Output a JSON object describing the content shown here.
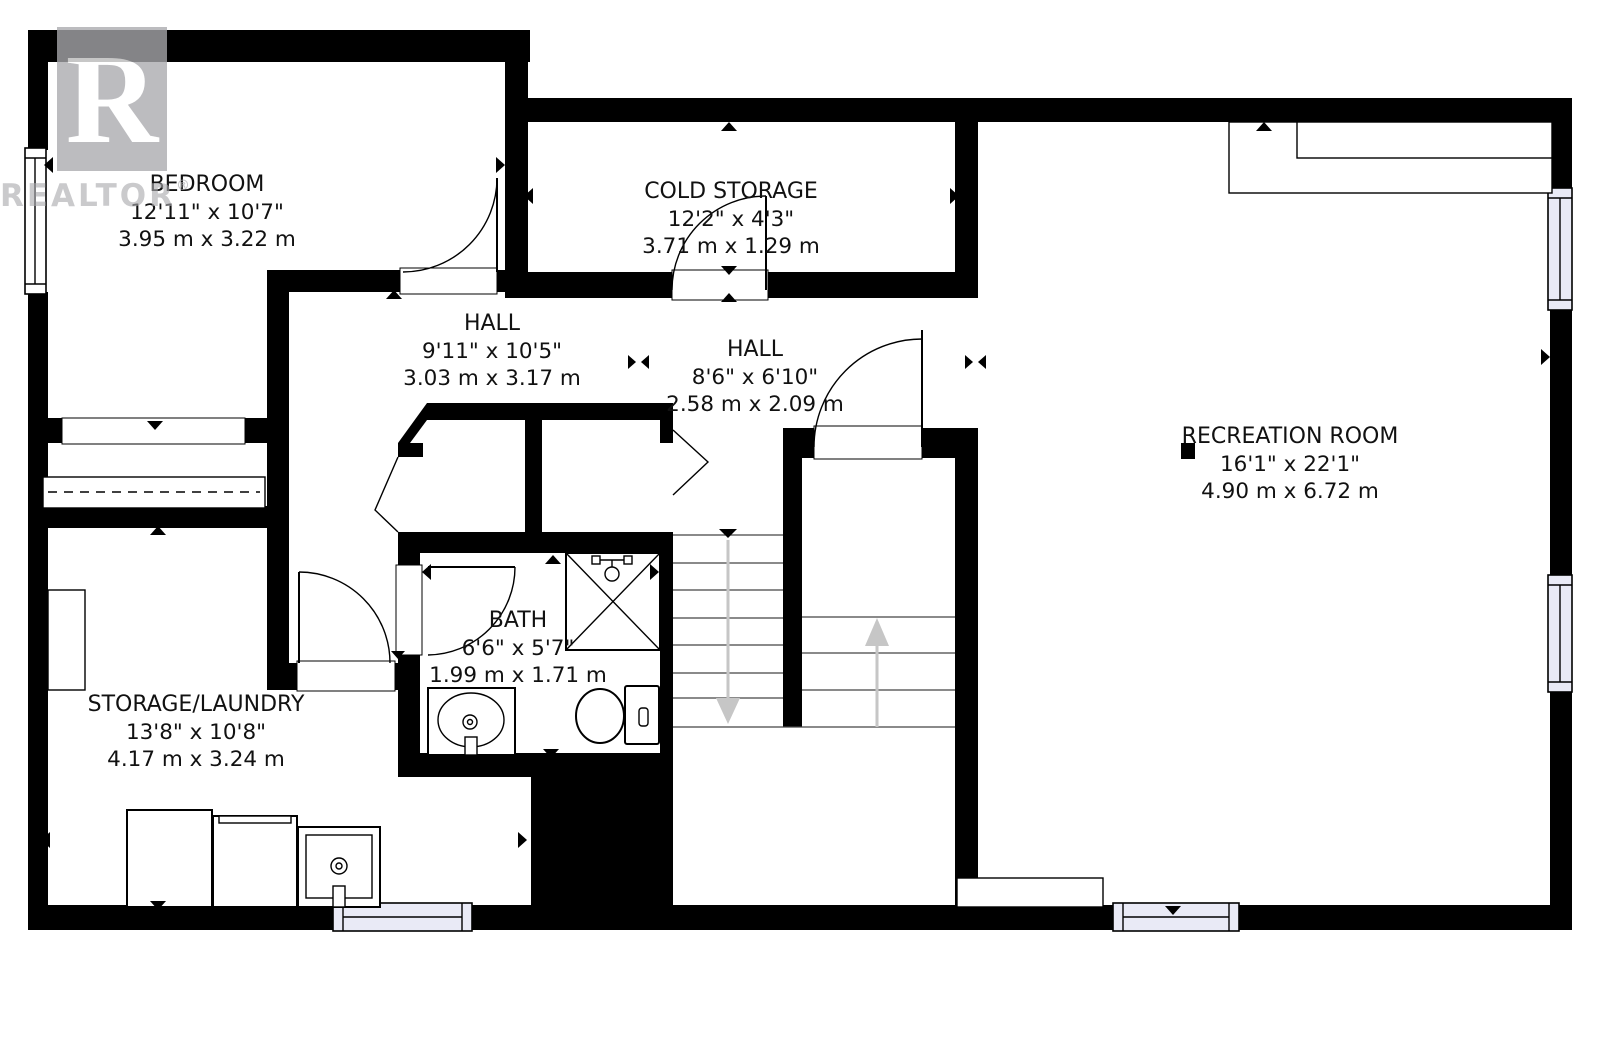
{
  "title": "Basement floor plan",
  "watermark": {
    "logo_letter": "R",
    "text": "REALTOR",
    "registered": "®"
  },
  "rooms": {
    "bedroom": {
      "name": "BEDROOM",
      "imperial": "12'11\" x 10'7\"",
      "metric": "3.95 m x 3.22 m"
    },
    "cold_storage": {
      "name": "COLD STORAGE",
      "imperial": "12'2\" x 4'3\"",
      "metric": "3.71 m x 1.29 m"
    },
    "hall1": {
      "name": "HALL",
      "imperial": "9'11\" x 10'5\"",
      "metric": "3.03 m x 3.17 m"
    },
    "hall2": {
      "name": "HALL",
      "imperial": "8'6\" x 6'10\"",
      "metric": "2.58 m x 2.09 m"
    },
    "recreation": {
      "name": "RECREATION ROOM",
      "imperial": "16'1\" x 22'1\"",
      "metric": "4.90 m x 6.72 m"
    },
    "bath": {
      "name": "BATH",
      "imperial": "6'6\" x 5'7\"",
      "metric": "1.99 m x 1.71 m"
    },
    "storage_laundry": {
      "name": "STORAGE/LAUNDRY",
      "imperial": "13'8\" x 10'8\"",
      "metric": "4.17 m x 3.24 m"
    }
  },
  "stairs": {
    "left_flight_arrow": "down",
    "right_flight_arrow": "up"
  },
  "fixtures": [
    "shower",
    "toilet",
    "sink-vanity",
    "laundry-tub",
    "washer",
    "dryer",
    "closet-rod",
    "counter",
    "post"
  ],
  "colors": {
    "wall": "#000000",
    "window_fill": "#e9eaf6",
    "stair_arrow": "#c6c6c6",
    "watermark": "#aaaaae",
    "text": "#111111"
  }
}
